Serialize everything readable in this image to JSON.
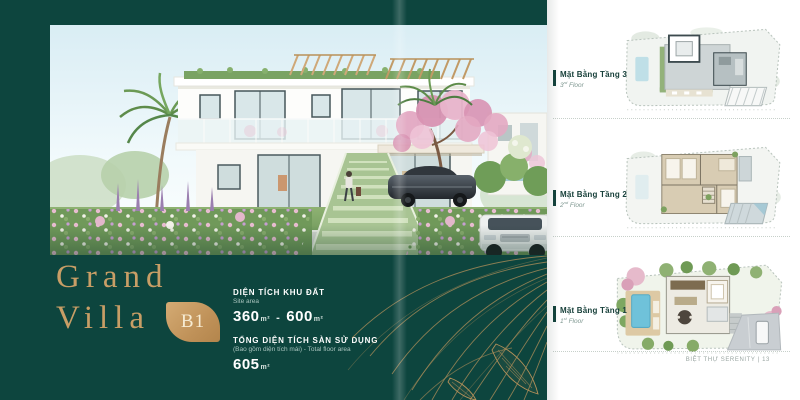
{
  "left_page": {
    "title_line1": "Grand",
    "title_line2": "Villa",
    "badge_code": "B1",
    "specs": {
      "land": {
        "label": "DIỆN TÍCH KHU ĐẤT",
        "sublabel": "Site area",
        "value_min": "360",
        "value_max": "600",
        "unit": "m²",
        "separator": "-"
      },
      "floor": {
        "label": "TỔNG DIỆN TÍCH SÀN SỬ DỤNG",
        "sublabel": "(Bao gồm diện tích mái) - Total floor area",
        "value": "605",
        "unit": "m²"
      }
    }
  },
  "right_page": {
    "plans": [
      {
        "title": "Mặt Bằng Tầng 3",
        "floor_num": "3",
        "floor_ord": "rd",
        "floor_word": "Floor"
      },
      {
        "title": "Mặt Bằng Tầng 2",
        "floor_num": "2",
        "floor_ord": "nd",
        "floor_word": "Floor"
      },
      {
        "title": "Mặt Bằng Tầng 1",
        "floor_num": "1",
        "floor_ord": "st",
        "floor_word": "Floor"
      }
    ],
    "footer": "BIỆT THỰ SERENITY | 13"
  },
  "colors": {
    "teal_background": "#0d453e",
    "gold_accent": "#c89e66",
    "label_dark": "#17403a"
  }
}
